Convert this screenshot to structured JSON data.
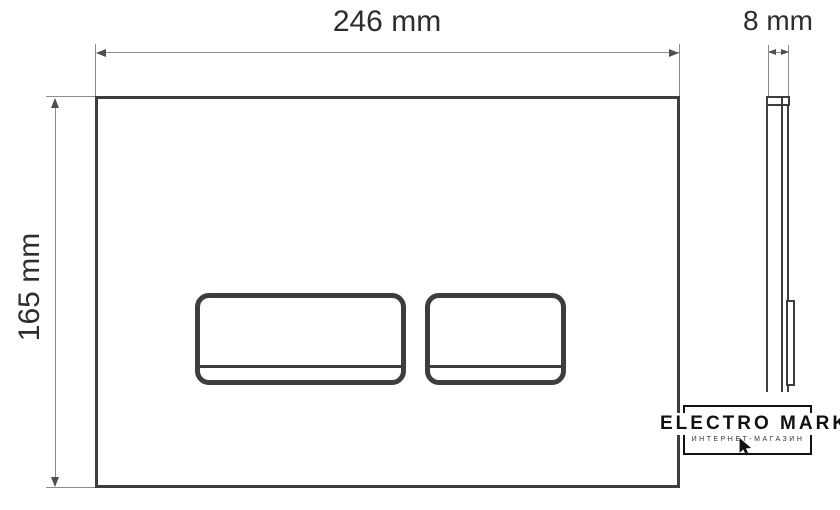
{
  "dimensions": {
    "width": {
      "label": "246 mm"
    },
    "height": {
      "label": "165 mm"
    },
    "depth": {
      "label": "8 mm"
    }
  },
  "logo": {
    "title": "ELECTRO MARKET",
    "subtitle": "ИНТЕРНЕТ-МАГАЗИН"
  },
  "colors": {
    "outline": "#3d3d3d",
    "dimension_line": "#8c8c8c",
    "arrow": "#4f4f4f",
    "text": "#2d2d2d",
    "logo": "#111111",
    "background": "#ffffff"
  }
}
